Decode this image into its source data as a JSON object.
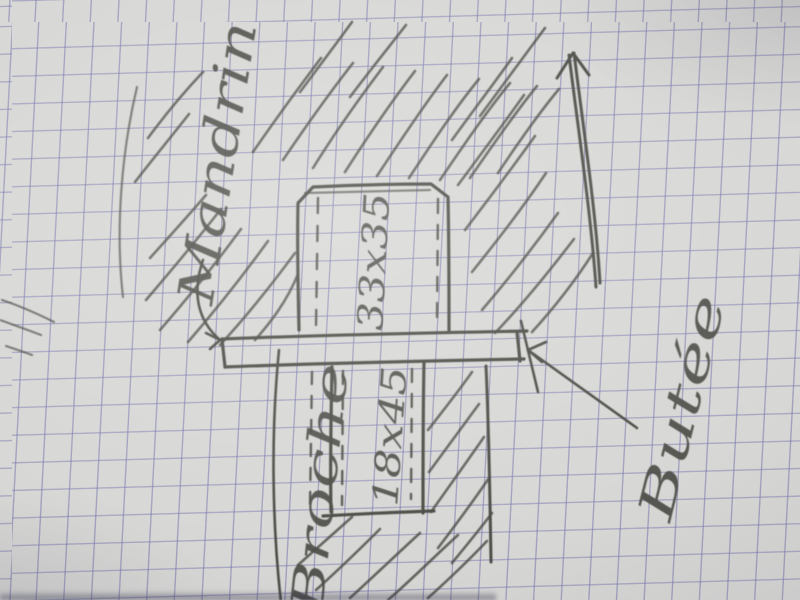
{
  "sketch": {
    "labels": {
      "chuck_label": "Mandrin",
      "stop_label": "Butée",
      "spindle_label": "Broche",
      "upper_part_dimension": "33x35",
      "lower_part_dimension": "18x45"
    },
    "colors": {
      "paper": "#d7d7d5",
      "grid_line": "#7676ae",
      "pencil_dark": "#4c4c46",
      "pencil_light": "#70706a"
    }
  }
}
